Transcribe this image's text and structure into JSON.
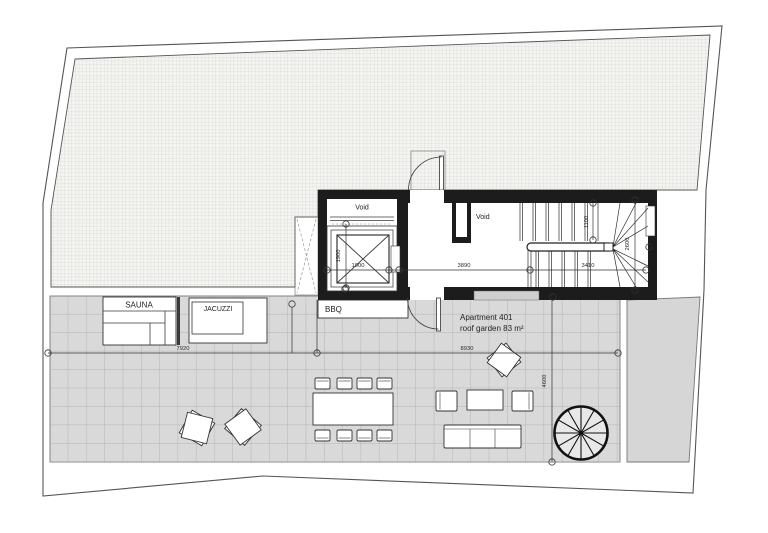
{
  "areas": {
    "sauna": "SAUNA",
    "jacuzzi": "JACUZZI",
    "bbq": "BBQ",
    "void_elevator": "Void",
    "void_lobby": "Void",
    "apartment_line1": "Apartment 401",
    "apartment_line2": "roof garden 83 m²"
  },
  "dimensions": {
    "elevator_width": "1900",
    "elevator_depth": "1900",
    "hall_width": "3890",
    "stair_run": "3410",
    "stair_flight_width": "1100",
    "stair_depth": "2600",
    "terrace_left": "7920",
    "terrace_right": "8930",
    "terrace_depth": "4600"
  },
  "colors": {
    "wall": "#1c1c1c",
    "hatch_bg": "#f4f4f1",
    "hatch_line": "#c9c9c9",
    "tile_fill": "#d9d9d9",
    "tile_line": "#a6a6a6",
    "outline": "#444444",
    "paper": "#ffffff"
  }
}
